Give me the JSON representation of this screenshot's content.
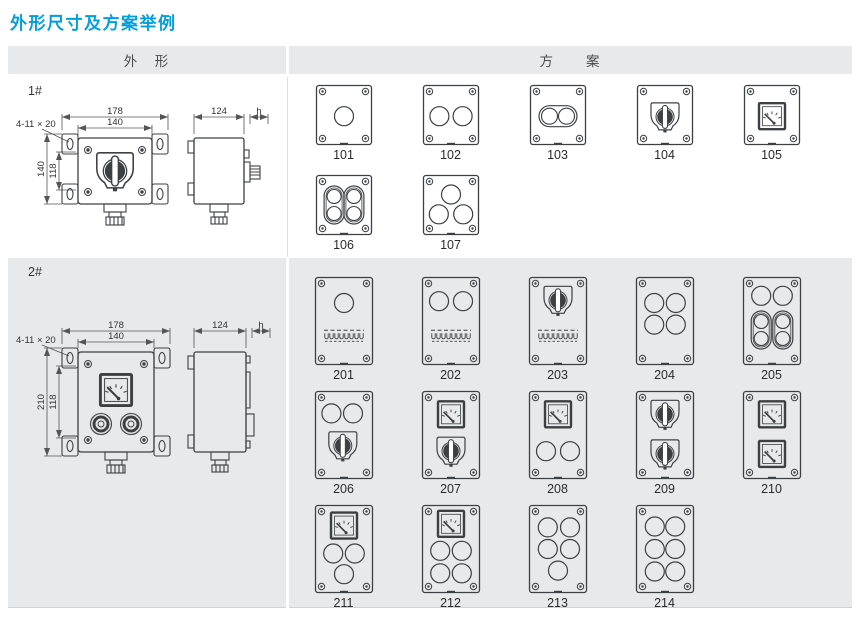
{
  "page": {
    "title": "外形尺寸及方案举例"
  },
  "colors": {
    "accent": "#00A0E0",
    "line": "#3d4043",
    "dim": "#555555",
    "row_bg": "#e7e9eb",
    "text": "#333333"
  },
  "table": {
    "header": {
      "outline": "外　形",
      "scheme": "方　　案"
    },
    "rows": [
      {
        "label": "1#",
        "dimensions": {
          "total_width": "178",
          "inner_width": "140",
          "total_height": "140",
          "inner_height": "118",
          "holes": "4-11 × 20",
          "depth": "124",
          "height_symbol": "h"
        },
        "schemes": [
          {
            "code": "101",
            "items": [
              {
                "t": "circle",
                "x": 0.5,
                "y": 0.52
              }
            ]
          },
          {
            "code": "102",
            "items": [
              {
                "t": "circle",
                "x": 0.3,
                "y": 0.52
              },
              {
                "t": "circle",
                "x": 0.7,
                "y": 0.52
              }
            ]
          },
          {
            "code": "103",
            "items": [
              {
                "t": "pillh",
                "x": 0.5,
                "y": 0.52
              }
            ]
          },
          {
            "code": "104",
            "items": [
              {
                "t": "rotary",
                "x": 0.5,
                "y": 0.53
              }
            ]
          },
          {
            "code": "105",
            "items": [
              {
                "t": "meter",
                "x": 0.5,
                "y": 0.52
              }
            ]
          },
          {
            "code": "106",
            "items": [
              {
                "t": "pillv",
                "x": 0.33,
                "y": 0.5
              },
              {
                "t": "pillv",
                "x": 0.67,
                "y": 0.5
              }
            ]
          },
          {
            "code": "107",
            "items": [
              {
                "t": "circle",
                "x": 0.5,
                "y": 0.33
              },
              {
                "t": "circle",
                "x": 0.29,
                "y": 0.65
              },
              {
                "t": "circle",
                "x": 0.71,
                "y": 0.65
              }
            ]
          }
        ]
      },
      {
        "label": "2#",
        "dimensions": {
          "total_width": "178",
          "inner_width": "140",
          "total_height": "210",
          "inner_height": "118",
          "holes": "4-11 × 20",
          "depth": "124",
          "height_symbol": "h"
        },
        "schemes": [
          {
            "code": "201",
            "items": [
              {
                "t": "circle",
                "x": 0.5,
                "y": 0.3
              },
              {
                "t": "terminal",
                "x": 0.5,
                "y": 0.67
              }
            ]
          },
          {
            "code": "202",
            "items": [
              {
                "t": "circle",
                "x": 0.3,
                "y": 0.28
              },
              {
                "t": "circle",
                "x": 0.7,
                "y": 0.28
              },
              {
                "t": "terminal",
                "x": 0.5,
                "y": 0.67
              }
            ]
          },
          {
            "code": "203",
            "items": [
              {
                "t": "rotary",
                "x": 0.5,
                "y": 0.27
              },
              {
                "t": "terminal",
                "x": 0.5,
                "y": 0.67
              }
            ]
          },
          {
            "code": "204",
            "items": [
              {
                "t": "circle",
                "x": 0.32,
                "y": 0.3
              },
              {
                "t": "circle",
                "x": 0.68,
                "y": 0.3
              },
              {
                "t": "circle",
                "x": 0.32,
                "y": 0.54
              },
              {
                "t": "circle",
                "x": 0.68,
                "y": 0.54
              }
            ]
          },
          {
            "code": "205",
            "items": [
              {
                "t": "circle",
                "x": 0.32,
                "y": 0.22
              },
              {
                "t": "circle",
                "x": 0.68,
                "y": 0.22
              },
              {
                "t": "pillv",
                "x": 0.32,
                "y": 0.6
              },
              {
                "t": "pillv",
                "x": 0.68,
                "y": 0.6
              }
            ]
          },
          {
            "code": "206",
            "items": [
              {
                "t": "circle",
                "x": 0.29,
                "y": 0.26
              },
              {
                "t": "circle",
                "x": 0.65,
                "y": 0.26
              },
              {
                "t": "rotary",
                "x": 0.48,
                "y": 0.62
              }
            ]
          },
          {
            "code": "207",
            "items": [
              {
                "t": "meter",
                "x": 0.5,
                "y": 0.27
              },
              {
                "t": "rotary",
                "x": 0.5,
                "y": 0.68
              }
            ]
          },
          {
            "code": "208",
            "items": [
              {
                "t": "meter",
                "x": 0.5,
                "y": 0.27
              },
              {
                "t": "circle",
                "x": 0.3,
                "y": 0.68
              },
              {
                "t": "circle",
                "x": 0.7,
                "y": 0.68
              }
            ]
          },
          {
            "code": "209",
            "items": [
              {
                "t": "rotary",
                "x": 0.5,
                "y": 0.27
              },
              {
                "t": "rotary",
                "x": 0.5,
                "y": 0.71
              }
            ]
          },
          {
            "code": "210",
            "items": [
              {
                "t": "meter",
                "x": 0.5,
                "y": 0.27
              },
              {
                "t": "meter",
                "x": 0.5,
                "y": 0.71
              }
            ]
          },
          {
            "code": "211",
            "items": [
              {
                "t": "meter",
                "x": 0.5,
                "y": 0.24
              },
              {
                "t": "circle",
                "x": 0.32,
                "y": 0.55
              },
              {
                "t": "circle",
                "x": 0.68,
                "y": 0.55
              },
              {
                "t": "circle",
                "x": 0.5,
                "y": 0.78
              }
            ]
          },
          {
            "code": "212",
            "items": [
              {
                "t": "meter",
                "x": 0.5,
                "y": 0.22
              },
              {
                "t": "circle",
                "x": 0.32,
                "y": 0.52
              },
              {
                "t": "circle",
                "x": 0.68,
                "y": 0.52
              },
              {
                "t": "circle",
                "x": 0.32,
                "y": 0.77
              },
              {
                "t": "circle",
                "x": 0.68,
                "y": 0.77
              }
            ]
          },
          {
            "code": "213",
            "items": [
              {
                "t": "circle",
                "x": 0.33,
                "y": 0.26
              },
              {
                "t": "circle",
                "x": 0.7,
                "y": 0.26
              },
              {
                "t": "circle",
                "x": 0.33,
                "y": 0.5
              },
              {
                "t": "circle",
                "x": 0.7,
                "y": 0.5
              },
              {
                "t": "circle",
                "x": 0.5,
                "y": 0.74
              }
            ]
          },
          {
            "code": "214",
            "items": [
              {
                "t": "circle",
                "x": 0.33,
                "y": 0.25
              },
              {
                "t": "circle",
                "x": 0.67,
                "y": 0.25
              },
              {
                "t": "circle",
                "x": 0.33,
                "y": 0.5
              },
              {
                "t": "circle",
                "x": 0.67,
                "y": 0.5
              },
              {
                "t": "circle",
                "x": 0.33,
                "y": 0.75
              },
              {
                "t": "circle",
                "x": 0.67,
                "y": 0.75
              }
            ]
          }
        ]
      }
    ]
  }
}
